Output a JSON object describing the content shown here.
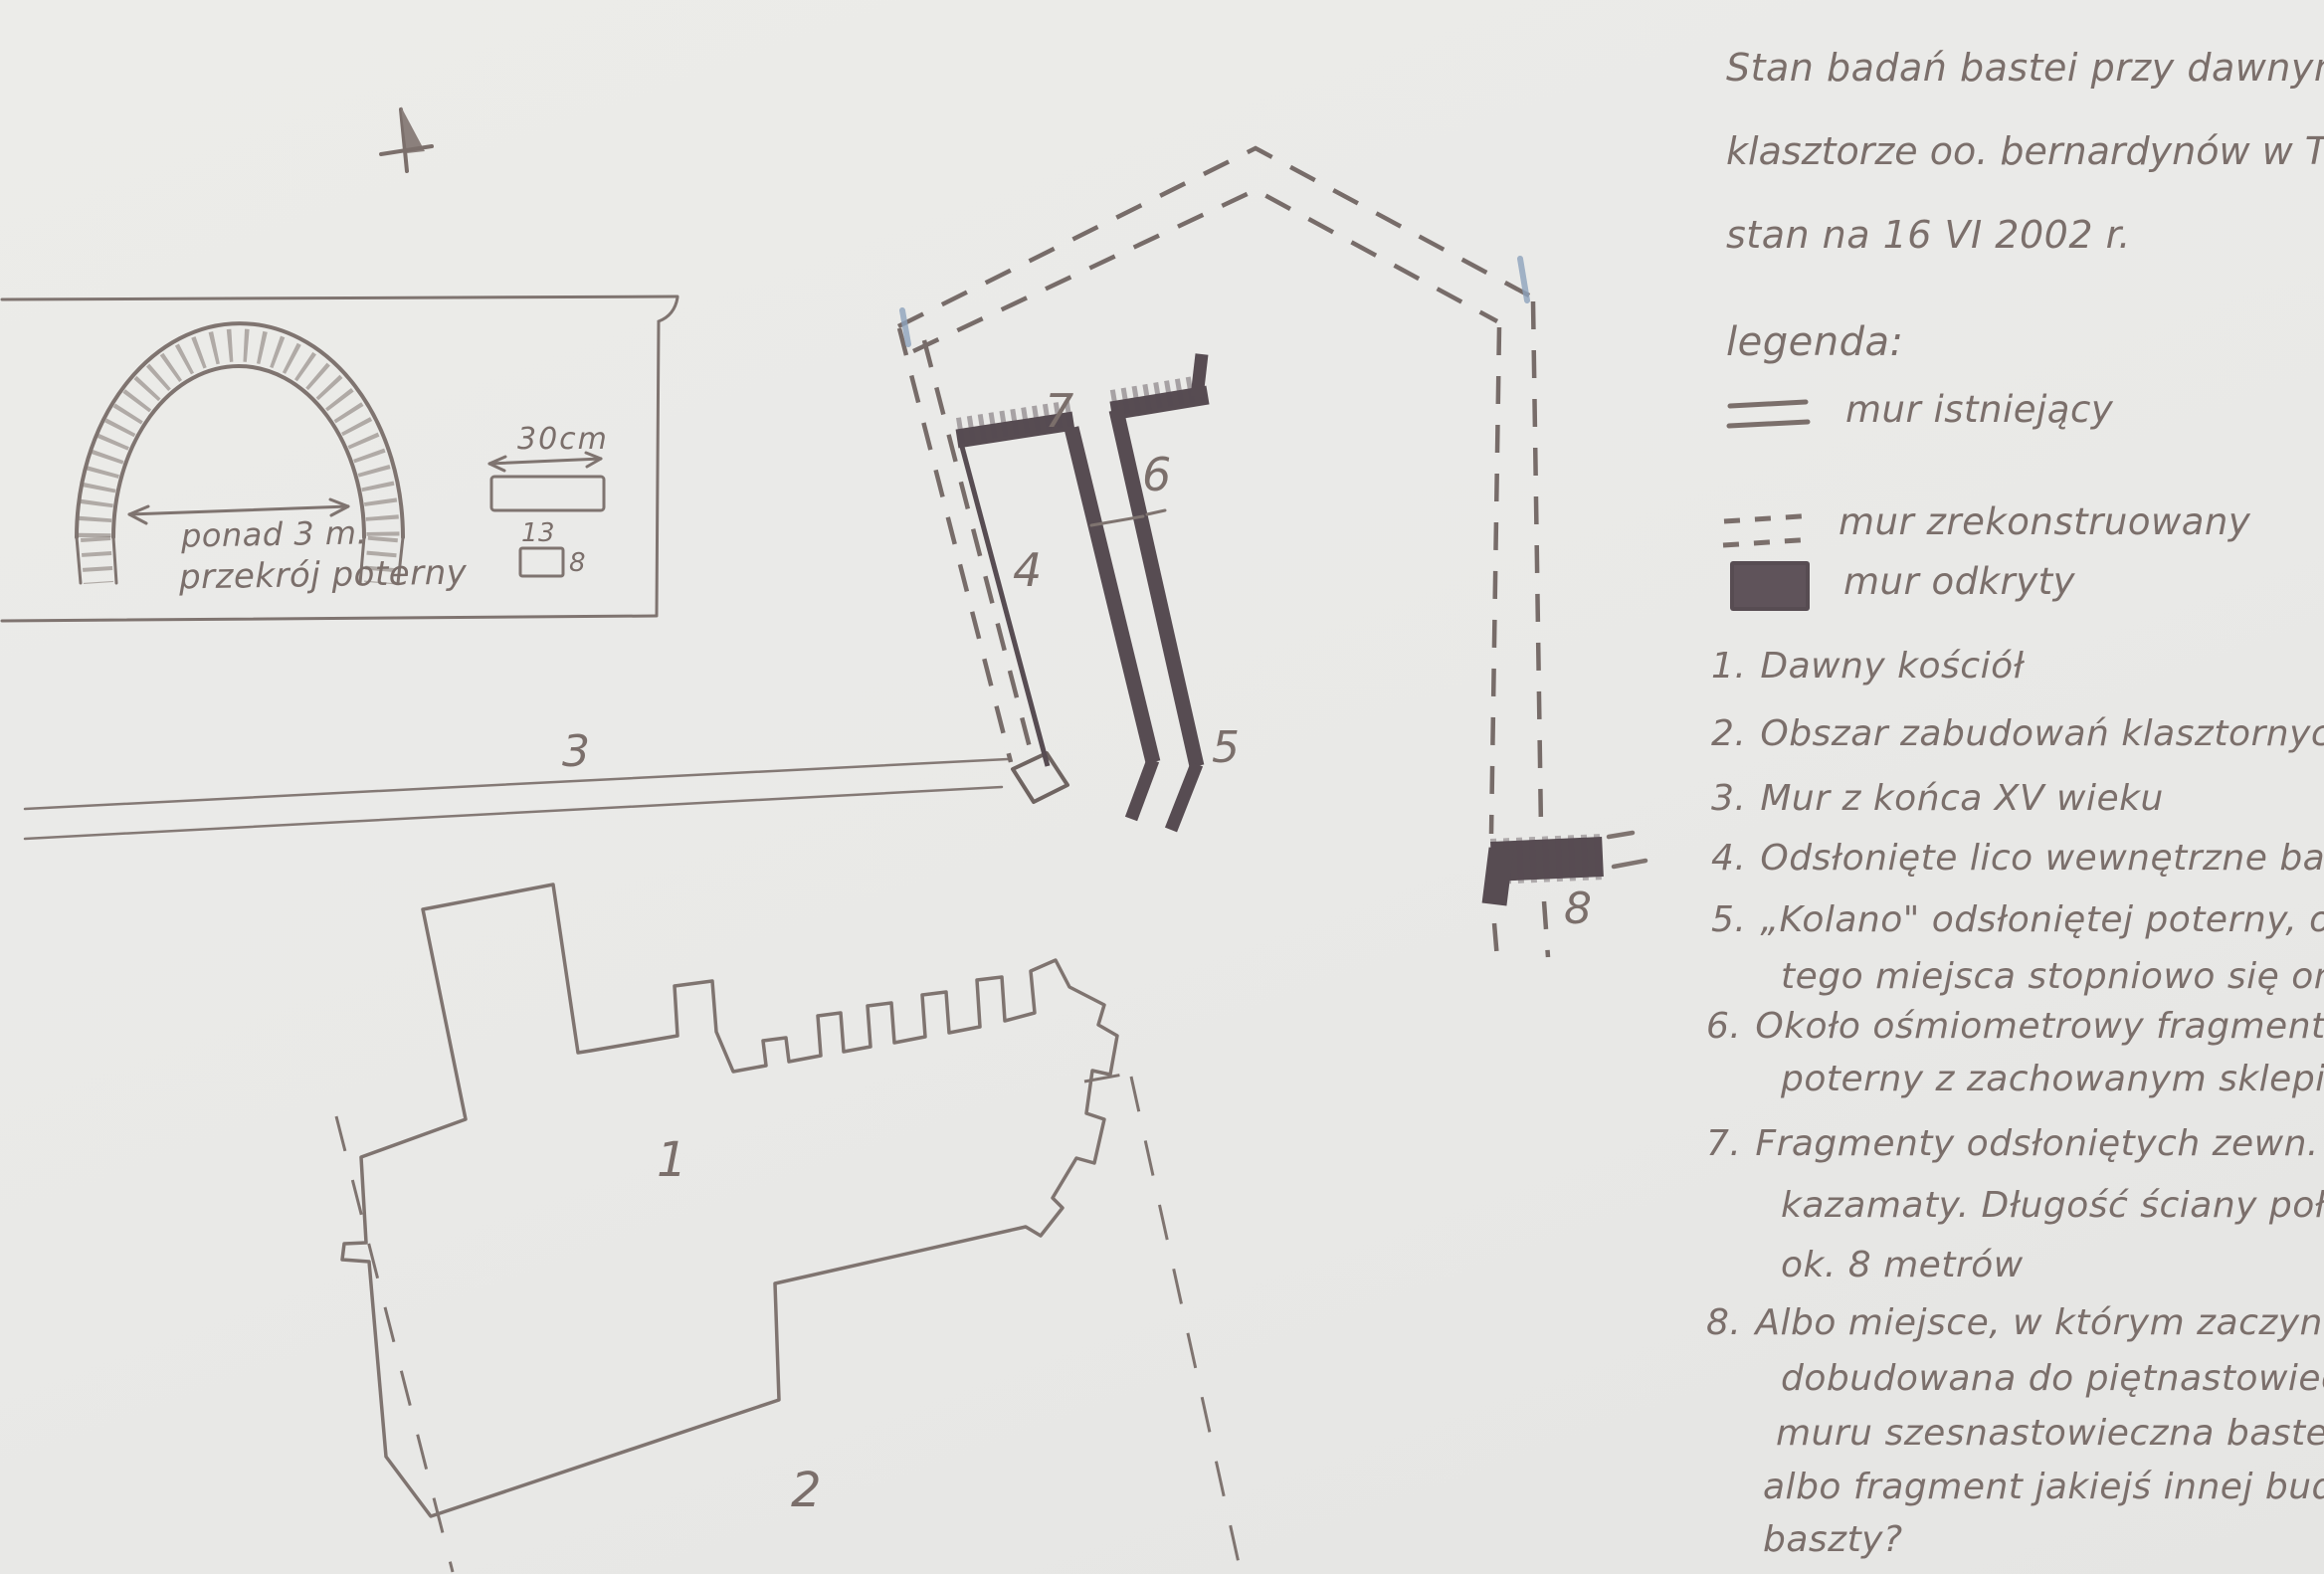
{
  "title": {
    "line1": "Stan badań bastei przy dawnym",
    "line2": "klasztorze oo. bernardynów w Tarnowie,",
    "line3": "stan na 16 VI 2002 r."
  },
  "legend": {
    "heading": "legenda:",
    "existing_wall": "mur istniejący",
    "reconstructed_wall": "mur zrekonstruowany",
    "uncovered_wall": "mur odkryty"
  },
  "notes": [
    {
      "num": "1.",
      "line1": "Dawny kościół"
    },
    {
      "num": "2.",
      "line1": "Obszar zabudowań klasztornych"
    },
    {
      "num": "3.",
      "line1": "Mur z końca XV wieku"
    },
    {
      "num": "4.",
      "line1": "Odsłonięte lico wewnętrzne bastei"
    },
    {
      "num": "5.",
      "line1": "„Kolano\" odsłoniętej poterny, od",
      "line2": "tego miejsca stopniowo się ona obniża"
    },
    {
      "num": "6.",
      "line1": "Około ośmiometrowy fragment",
      "line2": "poterny z zachowanym sklepieniem"
    },
    {
      "num": "7.",
      "line1": "Fragmenty odsłoniętych zewn. ścian",
      "line2": "kazamaty. Długość ściany połudn.",
      "line3": "ok. 8 metrów"
    },
    {
      "num": "8.",
      "line1": "Albo miejsce, w którym zaczyna się",
      "line2": "dobudowana do piętnastowiecznego",
      "line3": "muru szesnastowieczna basteja;",
      "line4": "albo fragment jakiejś innej budowli -",
      "line5": "baszty?"
    }
  ],
  "inset": {
    "span_label": "ponad 3 m.",
    "caption": "przekrój poterny",
    "scale_label": "30cm",
    "brick_width_label": "13",
    "brick_height_label": "8"
  },
  "plan_labels": {
    "n1": "1",
    "n2": "2",
    "n3": "3",
    "n4": "4",
    "n5": "5",
    "n6": "6",
    "n7": "7",
    "n8": "8"
  },
  "icons": {
    "north_arrow": "north-arrow"
  },
  "colors": {
    "paper": "#e9e9e7",
    "ink": "#7b6f6b",
    "uncovered_wall_fill": "#574c52",
    "corner_tick_blue": "#8ea3bd"
  }
}
